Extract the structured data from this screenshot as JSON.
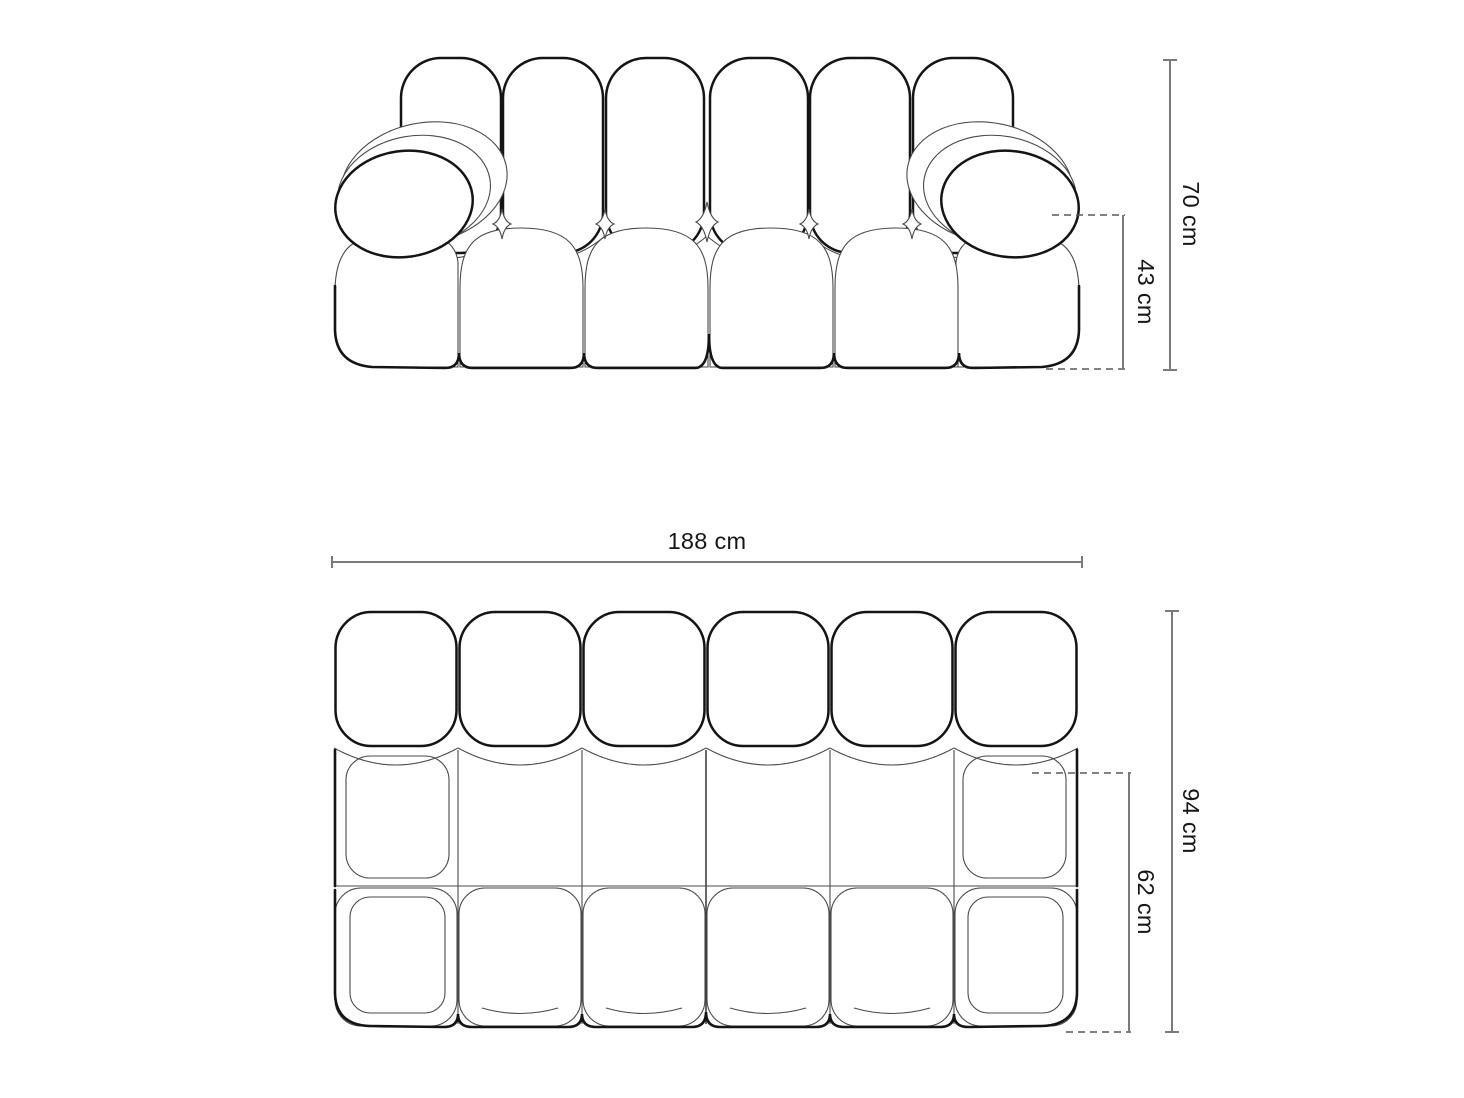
{
  "dimensions": {
    "front_view": {
      "total_height": "70 cm",
      "seat_height": "43 cm"
    },
    "top_view": {
      "total_width": "188 cm",
      "total_depth": "94 cm",
      "seat_depth": "62 cm"
    }
  },
  "colors": {
    "outline": "#141414",
    "seam": "#4a4a4a",
    "dimension_line": "#7a7a7a",
    "dashed_line": "#585858",
    "text": "#161616",
    "background": "#ffffff"
  }
}
